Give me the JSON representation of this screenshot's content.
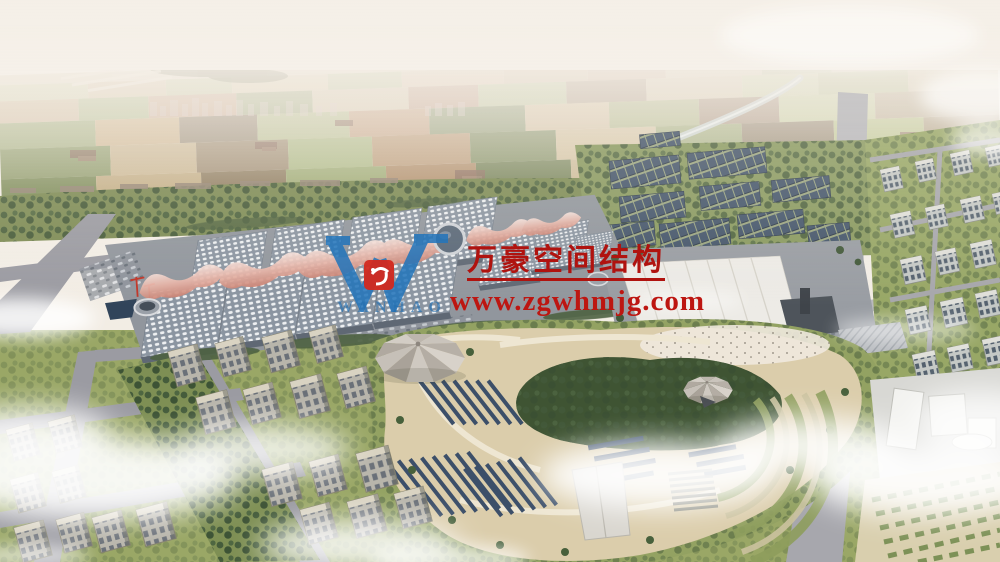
{
  "watermark": {
    "logo": {
      "monogram": "W",
      "brand_text": "WANHAO",
      "blue": "#2475ba",
      "seal_red": "#d3291f"
    },
    "company_name": "万豪空间结构",
    "website": "www.zgwhmjg.com",
    "text_red": "#b5130e"
  },
  "scene": {
    "palette": {
      "sky_haze": "#f6f1ea",
      "farmland_tan": "#c9b28a",
      "greenbelt_olive": "#7e8c55",
      "hall_roof_grey": "#8b95a1",
      "canopy_pink": "#d98a7a",
      "solar_panel_blue": "#45566b",
      "park_sand": "#dbcdab",
      "road_grey": "#9b9ba2",
      "cloud_white": "#ffffff"
    }
  }
}
